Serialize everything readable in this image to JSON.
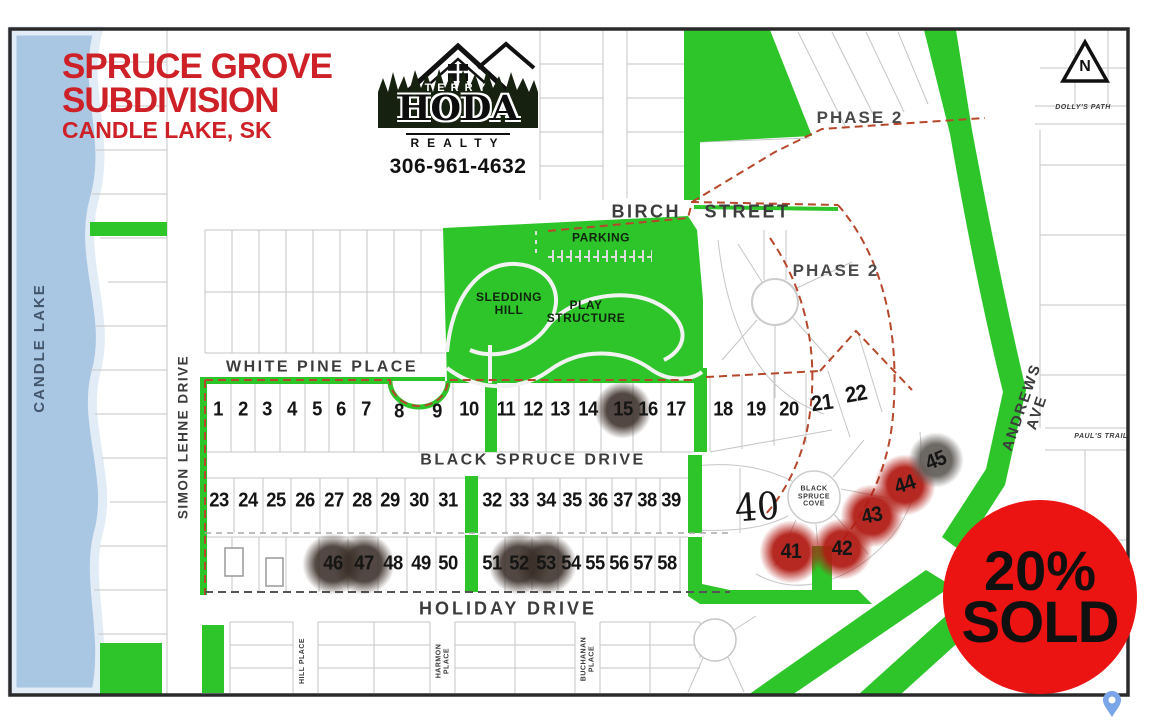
{
  "title": {
    "line1": "SPRUCE GROVE",
    "line2": "SUBDIVISION",
    "line3": "CANDLE LAKE, SK"
  },
  "logo": {
    "brand_top": "TERRY",
    "brand_main": "HODA",
    "brand_sub": "REALTY",
    "phone": "306-961-4632"
  },
  "badge": {
    "line1": "20%",
    "line2": "SOLD"
  },
  "north_label": "N",
  "water": {
    "name": "CANDLE LAKE"
  },
  "areas": {
    "phase2_top": "PHASE 2",
    "phase2_mid": "PHASE 2",
    "parking": "PARKING",
    "sledding_hill": "SLEDDING\nHILL",
    "play_structure": "PLAY\nSTRUCTURE"
  },
  "streets": {
    "birch": "BIRCH STREET",
    "white_pine": "WHITE PINE PLACE",
    "black_spruce": "BLACK SPRUCE DRIVE",
    "holiday": "HOLIDAY DRIVE",
    "simon_lehne": "SIMON LEHNE DRIVE",
    "andrews": "ANDREWS AVE",
    "dollys": "DOLLY'S PATH",
    "pauls": "PAUL'S TRAIL",
    "hill": "HILL PLACE",
    "harmon": "HARMON\nPLACE",
    "buchanan": "BUCHANAN\nPLACE",
    "cove": "BLACK\nSPRUCE\nCOVE"
  },
  "lots": {
    "rows": [
      {
        "name": "white-pine-row",
        "y": 410,
        "size": 20,
        "items": [
          {
            "n": "1",
            "x": 218
          },
          {
            "n": "2",
            "x": 243
          },
          {
            "n": "3",
            "x": 267
          },
          {
            "n": "4",
            "x": 292
          },
          {
            "n": "5",
            "x": 317
          },
          {
            "n": "6",
            "x": 341
          },
          {
            "n": "7",
            "x": 366
          },
          {
            "n": "8",
            "x": 399,
            "y": 412
          },
          {
            "n": "9",
            "x": 437,
            "y": 412
          },
          {
            "n": "10",
            "x": 469
          },
          {
            "n": "11",
            "x": 506
          },
          {
            "n": "12",
            "x": 533
          },
          {
            "n": "13",
            "x": 560
          },
          {
            "n": "14",
            "x": 588
          },
          {
            "n": "15",
            "x": 623
          },
          {
            "n": "16",
            "x": 648
          },
          {
            "n": "17",
            "x": 676
          },
          {
            "n": "18",
            "x": 723
          },
          {
            "n": "19",
            "x": 756
          },
          {
            "n": "20",
            "x": 789
          },
          {
            "n": "21",
            "x": 822,
            "y": 403,
            "rot": -8,
            "size": 22
          },
          {
            "n": "22",
            "x": 856,
            "y": 394,
            "rot": -10,
            "size": 22
          }
        ]
      },
      {
        "name": "black-spruce-row",
        "y": 501,
        "size": 20,
        "items": [
          {
            "n": "23",
            "x": 219
          },
          {
            "n": "24",
            "x": 248
          },
          {
            "n": "25",
            "x": 276
          },
          {
            "n": "26",
            "x": 305
          },
          {
            "n": "27",
            "x": 334
          },
          {
            "n": "28",
            "x": 362
          },
          {
            "n": "29",
            "x": 390
          },
          {
            "n": "30",
            "x": 419
          },
          {
            "n": "31",
            "x": 448
          },
          {
            "n": "32",
            "x": 492
          },
          {
            "n": "33",
            "x": 519
          },
          {
            "n": "34",
            "x": 546
          },
          {
            "n": "35",
            "x": 572
          },
          {
            "n": "36",
            "x": 598
          },
          {
            "n": "37",
            "x": 623
          },
          {
            "n": "38",
            "x": 647
          },
          {
            "n": "39",
            "x": 671
          }
        ]
      },
      {
        "name": "holiday-row",
        "y": 564,
        "size": 20,
        "items": [
          {
            "n": "46",
            "x": 333
          },
          {
            "n": "47",
            "x": 364
          },
          {
            "n": "48",
            "x": 393
          },
          {
            "n": "49",
            "x": 421
          },
          {
            "n": "50",
            "x": 448
          },
          {
            "n": "51",
            "x": 492
          },
          {
            "n": "52",
            "x": 519
          },
          {
            "n": "53",
            "x": 546
          },
          {
            "n": "54",
            "x": 571
          },
          {
            "n": "55",
            "x": 595
          },
          {
            "n": "56",
            "x": 619
          },
          {
            "n": "57",
            "x": 643
          },
          {
            "n": "58",
            "x": 667
          }
        ]
      },
      {
        "name": "cove-lots",
        "y": 500,
        "size": 21,
        "items": [
          {
            "n": "40",
            "x": 757,
            "y": 507,
            "size": 38,
            "rot": -4,
            "hand": true
          },
          {
            "n": "41",
            "x": 791,
            "y": 552
          },
          {
            "n": "42",
            "x": 842,
            "y": 549
          },
          {
            "n": "43",
            "x": 872,
            "y": 516,
            "rot": -12
          },
          {
            "n": "44",
            "x": 905,
            "y": 485,
            "rot": -18
          },
          {
            "n": "45",
            "x": 936,
            "y": 461,
            "rot": -22
          }
        ]
      }
    ]
  },
  "sold_markers": [
    {
      "lot": "15",
      "x": 623,
      "y": 410,
      "r": 21,
      "type": "dark"
    },
    {
      "lot": "41",
      "x": 791,
      "y": 552,
      "r": 23,
      "type": "red"
    },
    {
      "lot": "42",
      "x": 842,
      "y": 549,
      "r": 22,
      "type": "red"
    },
    {
      "lot": "43",
      "x": 872,
      "y": 516,
      "r": 23,
      "type": "red"
    },
    {
      "lot": "44",
      "x": 905,
      "y": 485,
      "r": 22,
      "type": "red"
    },
    {
      "lot": "45",
      "x": 936,
      "y": 460,
      "r": 20,
      "type": "gray"
    },
    {
      "lot": "46",
      "x": 333,
      "y": 564,
      "r": 22,
      "type": "dark"
    },
    {
      "lot": "47",
      "x": 364,
      "y": 564,
      "r": 22,
      "type": "dark"
    },
    {
      "lot": "52",
      "x": 519,
      "y": 564,
      "r": 22,
      "type": "dark"
    },
    {
      "lot": "53",
      "x": 546,
      "y": 564,
      "r": 22,
      "type": "dark"
    }
  ],
  "colors": {
    "green": "#2ec52a",
    "lake": "#a9c6e3",
    "boundary": "#b5472b",
    "title_red": "#cd2027",
    "badge_red": "#ec1313",
    "marker_red": "#b01912",
    "marker_dark": "#3a2e28",
    "marker_gray": "#5c5854"
  }
}
